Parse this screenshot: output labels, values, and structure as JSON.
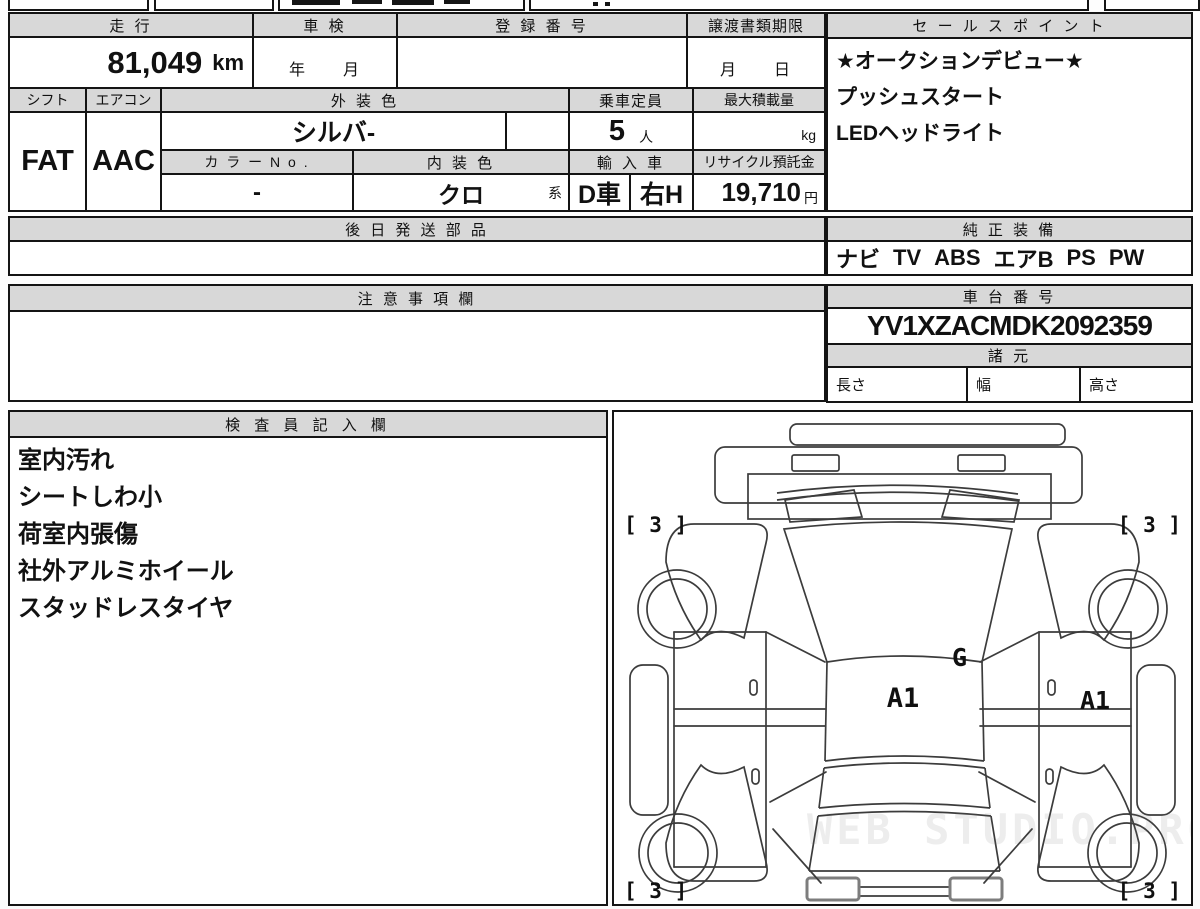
{
  "table": {
    "mileage": {
      "label": "走 行",
      "value": "81,049",
      "unit": "km"
    },
    "shaken": {
      "label": "車 検",
      "value": "年　　月"
    },
    "registration": {
      "label": "登 録 番 号",
      "value": ""
    },
    "transfer": {
      "label": "譲渡書類期限",
      "value": "月　　日"
    },
    "shift": {
      "label": "シフト",
      "value": "FAT"
    },
    "aircon": {
      "label": "エアコン",
      "value": "AAC"
    },
    "exterior_color": {
      "label": "外 装 色",
      "value": "シルバ-"
    },
    "capacity": {
      "label": "乗車定員",
      "value": "5",
      "unit": "人"
    },
    "payload": {
      "label": "最大積載量",
      "unit": "kg"
    },
    "color_no": {
      "label": "カ ラ ー N o .",
      "value": "-"
    },
    "interior_color": {
      "label": "内 装 色",
      "value": "クロ",
      "suffix": "系"
    },
    "import": {
      "label": "輸 入 車",
      "value": "D車",
      "handle": "右H"
    },
    "recycle": {
      "label": "リサイクル預託金",
      "value": "19,710",
      "unit": "円"
    }
  },
  "later_parts": {
    "title": "後 日 発 送 部 品",
    "content": ""
  },
  "sales_points": {
    "title": "セ ー ル ス ポ イ ン ト",
    "lines": [
      "★オークションデビュー★",
      "プッシュスタート",
      "LEDヘッドライト"
    ]
  },
  "equipment": {
    "title": "純 正 装 備",
    "items": [
      "ナビ",
      "TV",
      "ABS",
      "エアB",
      "PS",
      "PW"
    ]
  },
  "notes": {
    "title": "注 意 事 項 欄",
    "content": ""
  },
  "chassis": {
    "title": "車 台 番 号",
    "number": "YV1XZACMDK2092359"
  },
  "specs": {
    "title": "諸 元",
    "length_label": "長さ",
    "width_label": "幅",
    "height_label": "高さ"
  },
  "inspector": {
    "title": "検 査 員 記 入 欄",
    "lines": [
      "室内汚れ",
      "シートしわ小",
      "荷室内張傷",
      "社外アルミホイール",
      "スタッドレスタイヤ"
    ]
  },
  "diagram": {
    "corner_top_left": "[ 3 ]",
    "corner_top_right": "[ 3 ]",
    "corner_bottom_left": "[ 3 ]",
    "corner_bottom_right": "[ 3 ]",
    "label_g": "G",
    "label_a1_center": "A1",
    "label_a1_right": "A1",
    "watermark": "WEB STUDIO.PRO"
  }
}
